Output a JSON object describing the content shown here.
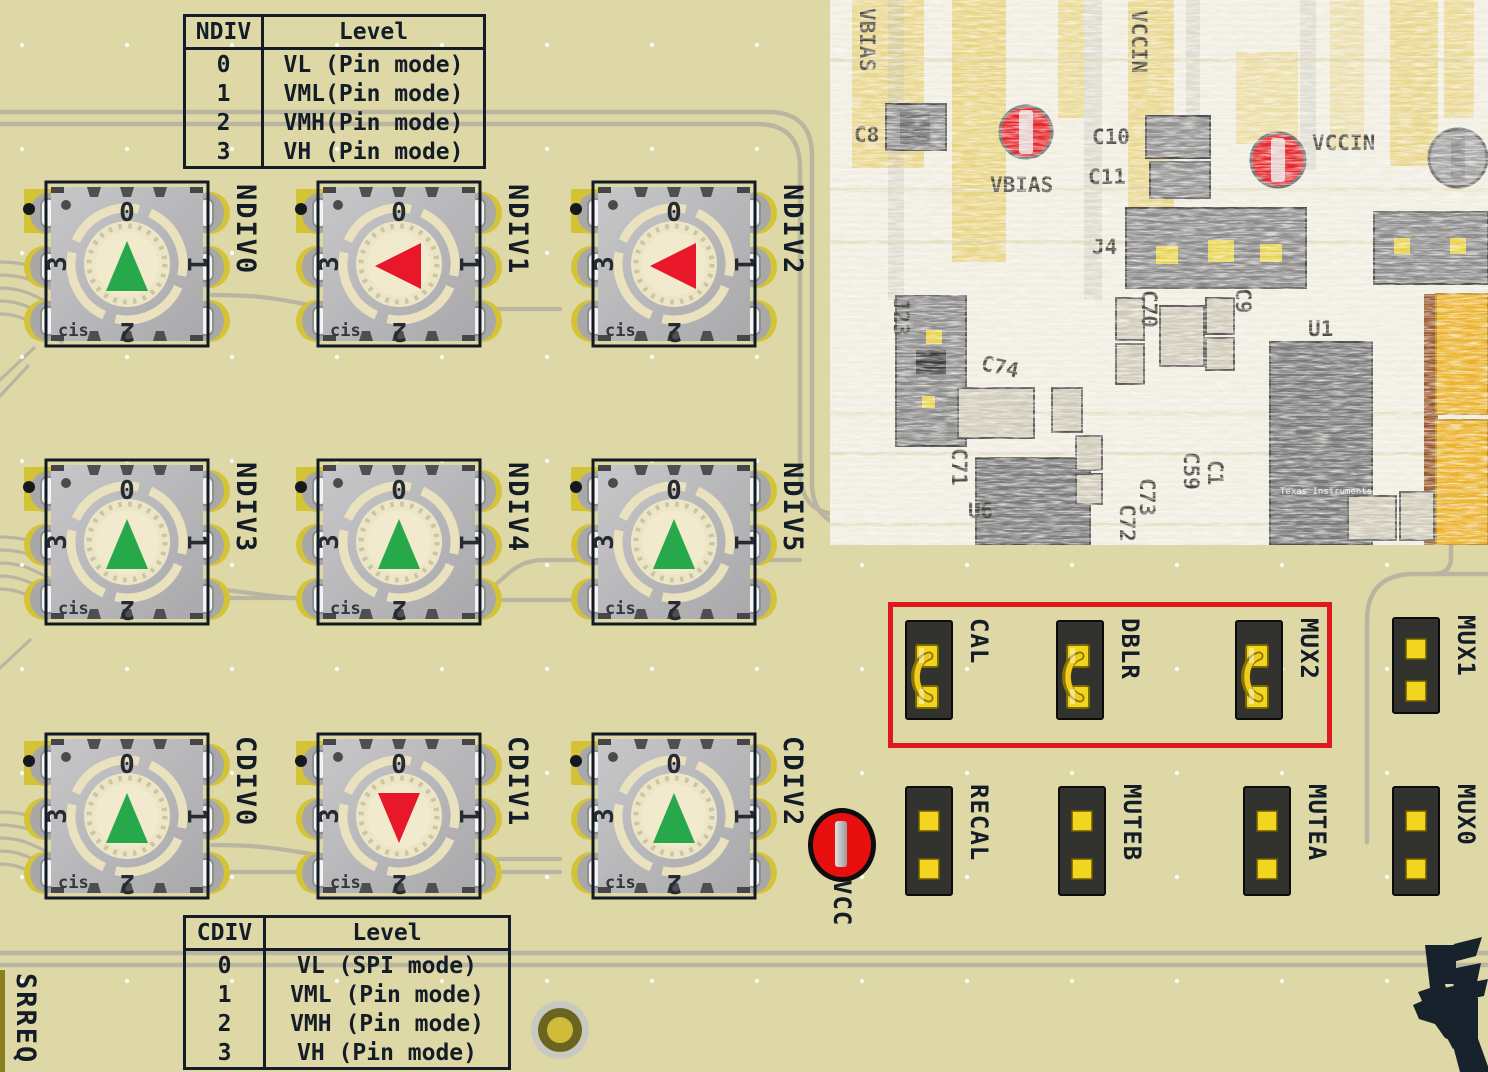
{
  "colors": {
    "board_bg": "#ddd8a5",
    "silkscreen_dark": "#141d27",
    "trace_gray": "#b9b5a1",
    "switch_body": "#b4b4b6",
    "pad_yellow": "#d5c336",
    "dial_cream": "#f1eacd",
    "arrow_green": "#27a84b",
    "arrow_red": "#e8182a",
    "jumper_body": "#32322e",
    "jumper_pad_yellow": "#f2d51e",
    "shunt_gold": "#f0cd1c",
    "highlight_box_red": "#e0181f",
    "vcc_red": "#e8100e",
    "photo_bg": "#f0ede1"
  },
  "ndiv_table": {
    "col_headers": [
      "NDIV",
      "Level"
    ],
    "rows": [
      [
        "0",
        "VL (Pin mode)"
      ],
      [
        "1",
        "VML(Pin mode)"
      ],
      [
        "2",
        "VMH(Pin mode)"
      ],
      [
        "3",
        "VH (Pin mode)"
      ]
    ]
  },
  "cdiv_table": {
    "col_headers": [
      "CDIV",
      "Level"
    ],
    "rows": [
      [
        "0",
        "VL (SPI mode)"
      ],
      [
        "1",
        "VML (Pin mode)"
      ],
      [
        "2",
        "VMH (Pin mode)"
      ],
      [
        "3",
        "VH (Pin mode)"
      ]
    ]
  },
  "dial": {
    "positions": [
      "0",
      "1",
      "2",
      "3"
    ],
    "cis_label": "cis"
  },
  "switches": [
    {
      "label": "NDIV0",
      "pointer": "up",
      "pointer_color": "green"
    },
    {
      "label": "NDIV1",
      "pointer": "left",
      "pointer_color": "red"
    },
    {
      "label": "NDIV2",
      "pointer": "left",
      "pointer_color": "red"
    },
    {
      "label": "NDIV3",
      "pointer": "up",
      "pointer_color": "green"
    },
    {
      "label": "NDIV4",
      "pointer": "up",
      "pointer_color": "green"
    },
    {
      "label": "NDIV5",
      "pointer": "up",
      "pointer_color": "green"
    },
    {
      "label": "CDIV0",
      "pointer": "up",
      "pointer_color": "green"
    },
    {
      "label": "CDIV1",
      "pointer": "down",
      "pointer_color": "red"
    },
    {
      "label": "CDIV2",
      "pointer": "up",
      "pointer_color": "green"
    }
  ],
  "jumpers": [
    {
      "label": "CAL",
      "shunt": true
    },
    {
      "label": "DBLR",
      "shunt": true
    },
    {
      "label": "MUX2",
      "shunt": true
    },
    {
      "label": "MUX1",
      "shunt": false
    },
    {
      "label": "RECAL",
      "shunt": false
    },
    {
      "label": "MUTEB",
      "shunt": false
    },
    {
      "label": "MUTEA",
      "shunt": false
    },
    {
      "label": "MUX0",
      "shunt": false
    }
  ],
  "test_points": {
    "vcc_label": "VCC"
  },
  "left_edge_label": "SRREQ",
  "photo": {
    "labels": [
      "VBIAS",
      "C8",
      "VBIAS",
      "VCCIN",
      "C10",
      "C11",
      "VCCIN",
      "J4",
      "J23",
      "C74",
      "C70",
      "C9",
      "U1",
      "U6",
      "C71",
      "C72",
      "C73",
      "C59",
      "C1"
    ],
    "ic_mark": "Texas Instruments"
  }
}
